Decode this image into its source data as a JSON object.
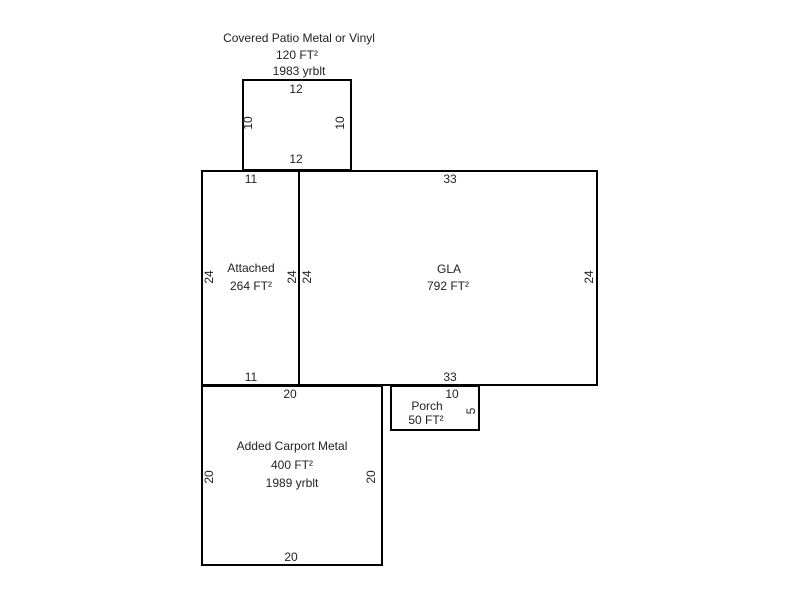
{
  "colors": {
    "line": "#000000",
    "text": "#222222",
    "background": "#ffffff"
  },
  "areas": {
    "patio": {
      "title": "Covered Patio Metal or Vinyl",
      "area": "120 FT²",
      "year_built": "1983 yrblt",
      "dim_top": "12",
      "dim_bottom": "12",
      "dim_left": "10",
      "dim_right": "10"
    },
    "attached": {
      "title": "Attached",
      "area": "264 FT²",
      "dim_top": "11",
      "dim_bottom": "11",
      "dim_left": "24",
      "dim_right": "24"
    },
    "gla": {
      "title": "GLA",
      "area": "792 FT²",
      "dim_top": "33",
      "dim_bottom": "33",
      "dim_left": "24",
      "dim_right": "24"
    },
    "porch": {
      "title": "Porch",
      "area": "50 FT²",
      "dim_top": "10",
      "dim_right": "5"
    },
    "carport": {
      "title": "Added Carport Metal",
      "area": "400 FT²",
      "year_built": "1989 yrblt",
      "dim_top": "20",
      "dim_bottom": "20",
      "dim_left": "20",
      "dim_right": "20"
    }
  }
}
